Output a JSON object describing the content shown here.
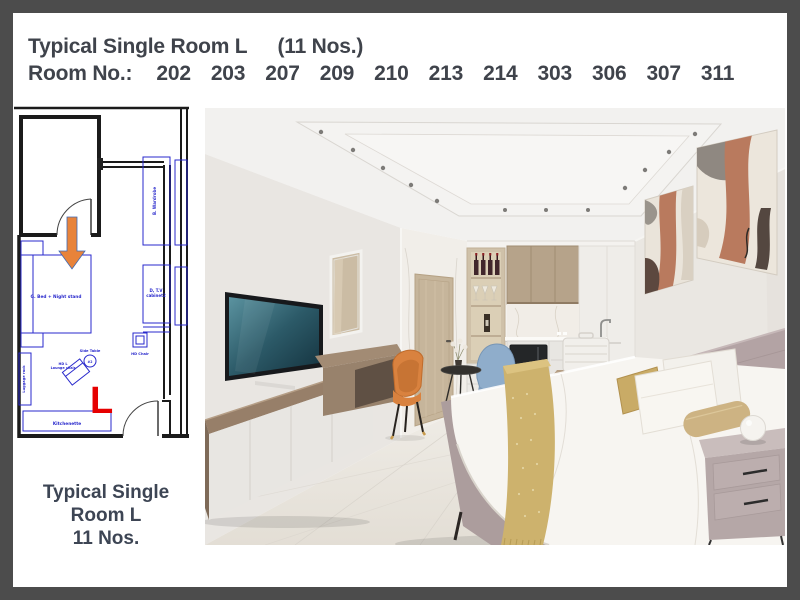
{
  "header": {
    "title": "Typical Single Room L",
    "count": "(11 Nos.)",
    "room_no_label": "Room No.:",
    "rooms": [
      "202",
      "203",
      "207",
      "209",
      "210",
      "213",
      "214",
      "303",
      "306",
      "307",
      "311"
    ]
  },
  "floor_plan": {
    "marker": "L",
    "labels": {
      "bed": "G. Bed + Night stand",
      "wardrobe": "B. Wardrobe",
      "tv_cabinet_line1": "D, T.V",
      "tv_cabinet_line2": "cabinet2",
      "hd_chair": "HD Chair",
      "side_table": "Side Table",
      "side_table_num": "#2",
      "lounge_line1": "HD L",
      "lounge_line2": "Lounge chair",
      "luggage": "Luggage rack",
      "kitchenette": "Kitchenette"
    }
  },
  "caption": {
    "line1": "Typical Single",
    "line2": "Room L",
    "line3": "11 Nos."
  },
  "colors": {
    "frame": "#4c4c4c",
    "heading_text": "#3f434b",
    "caption_text": "#3d4554",
    "plan_line": "#1b1b1b",
    "plan_furniture": "#2929cc",
    "marker_red": "#e60000",
    "arrow_orange": "#e8833a",
    "art_terracotta": "#b97a5e",
    "headboard_mauve": "#b3a3a4",
    "throw_gold": "#cdb26d",
    "chair_orange": "#d9823f",
    "chair_blue": "#8fadcb"
  }
}
